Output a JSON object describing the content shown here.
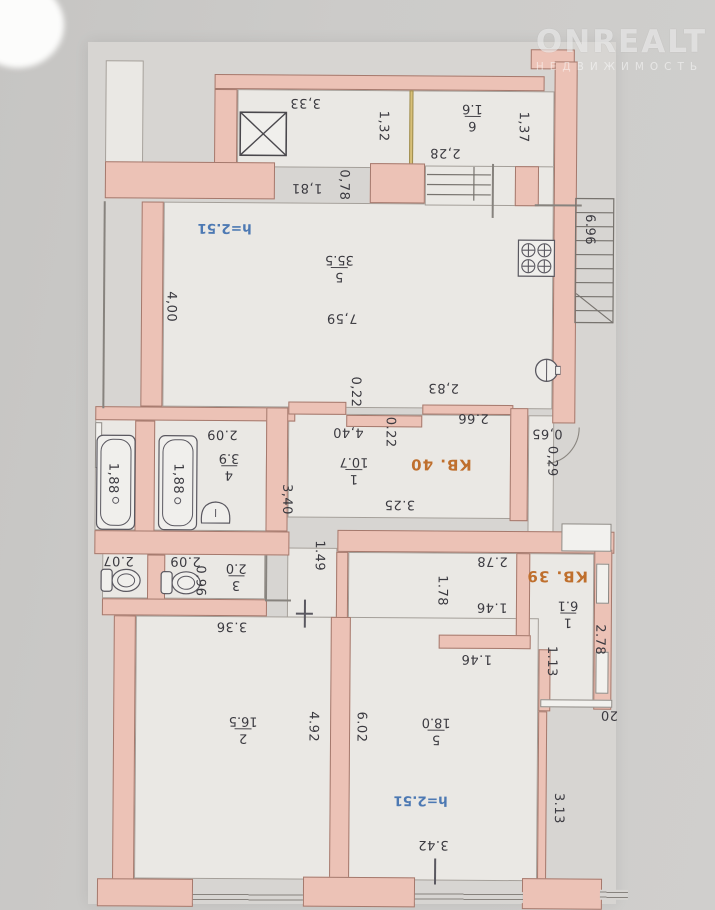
{
  "watermark": {
    "brand": "ONREALT",
    "subtitle": "НЕДВИЖИМОСТЬ"
  },
  "plan": {
    "apartments": {
      "a40": "КВ. 40",
      "a39": "КВ. 39"
    },
    "ceiling_heights": {
      "top": "h=2.51",
      "bottom": "h=2.51"
    },
    "rooms": {
      "r6": {
        "num": "6",
        "area": "1.6"
      },
      "r5_top": {
        "num": "5",
        "area": "35.5"
      },
      "r1_kv40": {
        "num": "1",
        "area": "10.7"
      },
      "r4": {
        "num": "4",
        "area": "3.9"
      },
      "r3": {
        "num": "3",
        "area": "2.0"
      },
      "r1_kv39": {
        "num": "1",
        "area": "6.1"
      },
      "r2": {
        "num": "2",
        "area": "16.5"
      },
      "r5_bottom": {
        "num": "5",
        "area": "18.0"
      }
    },
    "dims": {
      "d333": "3,33",
      "d132": "1,32",
      "d228": "2,28",
      "d137": "1,37",
      "d181": "1,81",
      "d078": "0,78",
      "d696": "6.96",
      "d400": "4,00",
      "d759": "7,59",
      "d283": "2,83",
      "d022a": "0,22",
      "d266": "2.66",
      "d022b": "0.22",
      "d440": "4,40",
      "d065": "0,65",
      "d029": "0,29",
      "d325": "3.25",
      "d209a": "2.09",
      "d188a": "1,88",
      "d188b": "1,88",
      "d340": "3,40",
      "d207": "2.07",
      "d209b": "2.09",
      "d096": "0.96",
      "d149": "1.49",
      "d336": "3.36",
      "d278a": "2.78",
      "d178": "1.78",
      "d146a": "1.46",
      "d146b": "1.46",
      "d278b": "2.78",
      "d113": "1.13",
      "d020": "20",
      "d492": "4.92",
      "d602": "6.02",
      "d342": "3.42",
      "d313": "3.13"
    },
    "fixtures": [
      "ventilation-shaft",
      "staircase",
      "entry-steps",
      "gas-stove",
      "kitchen-sink",
      "bathtub",
      "bathtub",
      "wash-basin",
      "toilet",
      "toilet"
    ]
  },
  "colors": {
    "wall_fill": "#ecc2b6",
    "wall_outline": "#a5796d",
    "paper": "#d7d5d2",
    "room": "#eae8e4",
    "dim_text": "#3b3a40",
    "height_blue": "#4d79b3",
    "apartment_orange": "#bf6f2d",
    "door_tan": "#d8c078"
  }
}
